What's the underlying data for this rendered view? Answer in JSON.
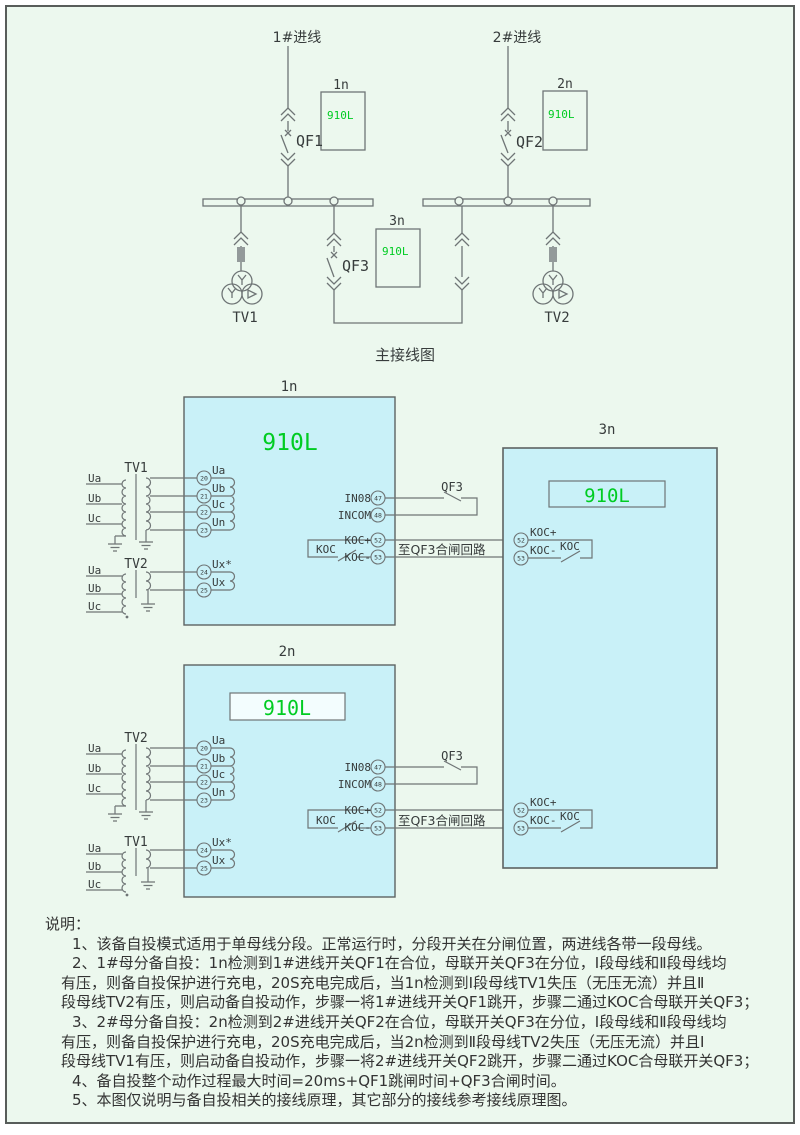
{
  "top": {
    "incoming1": "1#进线",
    "incoming2": "2#进线",
    "qf1": "QF1",
    "qf2": "QF2",
    "qf3": "QF3",
    "tv1": "TV1",
    "tv2": "TV2",
    "r1": {
      "tag": "1n",
      "model": "910L"
    },
    "r2": {
      "tag": "2n",
      "model": "910L"
    },
    "r3": {
      "tag": "3n",
      "model": "910L"
    },
    "title": "主接线图"
  },
  "unit1": {
    "tag": "1n",
    "model": "910L",
    "tv_top": "TV1",
    "tv_bottom": "TV2",
    "phases": [
      "Ua",
      "Ub",
      "Uc"
    ],
    "vt": [
      {
        "n": "20",
        "l": "Ua"
      },
      {
        "n": "21",
        "l": "Ub"
      },
      {
        "n": "22",
        "l": "Uc"
      },
      {
        "n": "23",
        "l": "Un"
      }
    ],
    "ux": [
      {
        "n": "24",
        "l": "Ux*"
      },
      {
        "n": "25",
        "l": "Ux"
      }
    ],
    "in08": "IN08",
    "n47": "47",
    "incom": "INCOM",
    "n48": "48",
    "qf3": "QF3",
    "kocp": "KOC+",
    "n52": "52",
    "kocm": "KOC-",
    "n53": "53",
    "koc": "KOC",
    "to_qf3": "至QF3合闸回路"
  },
  "unit2": {
    "tag": "2n",
    "model": "910L",
    "tv_top": "TV2",
    "tv_bottom": "TV1",
    "phases": [
      "Ua",
      "Ub",
      "Uc"
    ],
    "vt": [
      {
        "n": "20",
        "l": "Ua"
      },
      {
        "n": "21",
        "l": "Ub"
      },
      {
        "n": "22",
        "l": "Uc"
      },
      {
        "n": "23",
        "l": "Un"
      }
    ],
    "ux": [
      {
        "n": "24",
        "l": "Ux*"
      },
      {
        "n": "25",
        "l": "Ux"
      }
    ],
    "in08": "IN08",
    "n47": "47",
    "incom": "INCOM",
    "n48": "48",
    "qf3": "QF3",
    "kocp": "KOC+",
    "n52": "52",
    "kocm": "KOC-",
    "n53": "53",
    "koc": "KOC",
    "to_qf3": "至QF3合闸回路"
  },
  "unit3": {
    "tag": "3n",
    "model": "910L",
    "upper": {
      "kocp": "KOC+",
      "n52": "52",
      "kocm": "KOC-",
      "n53": "53",
      "koc": "KOC"
    },
    "lower": {
      "kocp": "KOC+",
      "n52": "52",
      "kocm": "KOC-",
      "n53": "53",
      "koc": "KOC"
    }
  },
  "notes": {
    "lines": [
      "说明：",
      "1、该备自投模式适用于单母线分段。正常运行时，分段开关在分闸位置，两进线各带一段母线。",
      "2、1#母分备自投：1n检测到1#进线开关QF1在合位，母联开关QF3在分位，Ⅰ段母线和Ⅱ段母线均",
      "有压，则备自投保护进行充电，20S充电完成后，当1n检测到Ⅰ段母线TV1失压（无压无流）并且Ⅱ",
      "段母线TV2有压，则启动备自投动作，步骤一将1#进线开关QF1跳开，步骤二通过KOC合母联开关QF3；",
      "3、2#母分备自投：2n检测到2#进线开关QF2在合位，母联开关QF3在分位，Ⅰ段母线和Ⅱ段母线均",
      "有压，则备自投保护进行充电，20S充电完成后，当2n检测到Ⅱ段母线TV2失压（无压无流）并且Ⅰ",
      "段母线TV1有压，则启动备自投动作，步骤一将2#进线开关QF2跳开，步骤二通过KOC合母联开关QF3；",
      "4、备自投整个动作过程最大时间=20ms+QF1跳闸时间+QF3合闸时间。",
      "5、本图仅说明与备自投相关的接线原理，其它部分的接线参考接线原理图。"
    ]
  }
}
